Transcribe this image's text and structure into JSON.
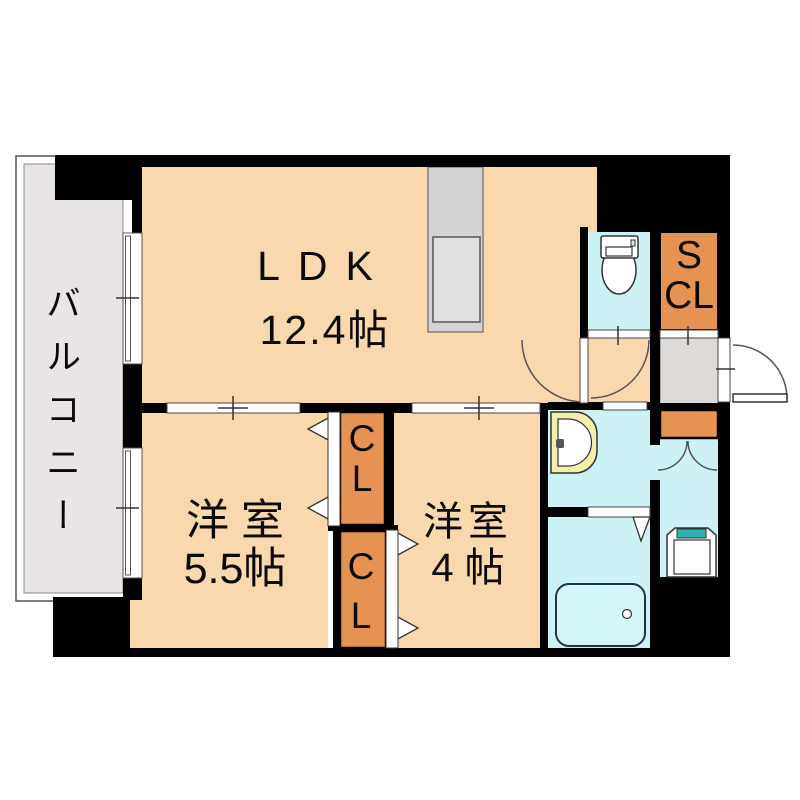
{
  "floor_plan": {
    "type": "apartment-floor-plan",
    "balcony": {
      "label": "バルコニー"
    },
    "ldk": {
      "label": "LDK",
      "size": "12.4帖"
    },
    "bedroom_west": {
      "label": "洋 室",
      "size": "5.5帖"
    },
    "bedroom_east": {
      "label": "洋室",
      "size": "4 帖"
    },
    "storage_closet": {
      "line1": "S",
      "line2": "CL"
    },
    "closet_west": {
      "line1": "C",
      "line2": "L"
    },
    "closet_east": {
      "line1": "C",
      "line2": "L"
    },
    "fixtures": {
      "kitchen": "kitchen-counter-icon",
      "toilet": "toilet-icon",
      "washbasin": "washbasin-icon",
      "bathtub": "bathtub-icon",
      "washing_machine": "washing-machine-pan-icon"
    },
    "colors": {
      "room_floor": "#f8d8ac",
      "water_area": "#cdf2f6",
      "closet_orange": "#e69252",
      "balcony_gray": "#e9e5e4",
      "entrance_gray": "#dedad8",
      "wall_black": "#000000",
      "washer_accent": "#2fb3b0",
      "basin_yellow": "#f3efad",
      "kitchen_gray": "#d3d3d3",
      "bathtub_fill": "#d4f6f8"
    }
  }
}
